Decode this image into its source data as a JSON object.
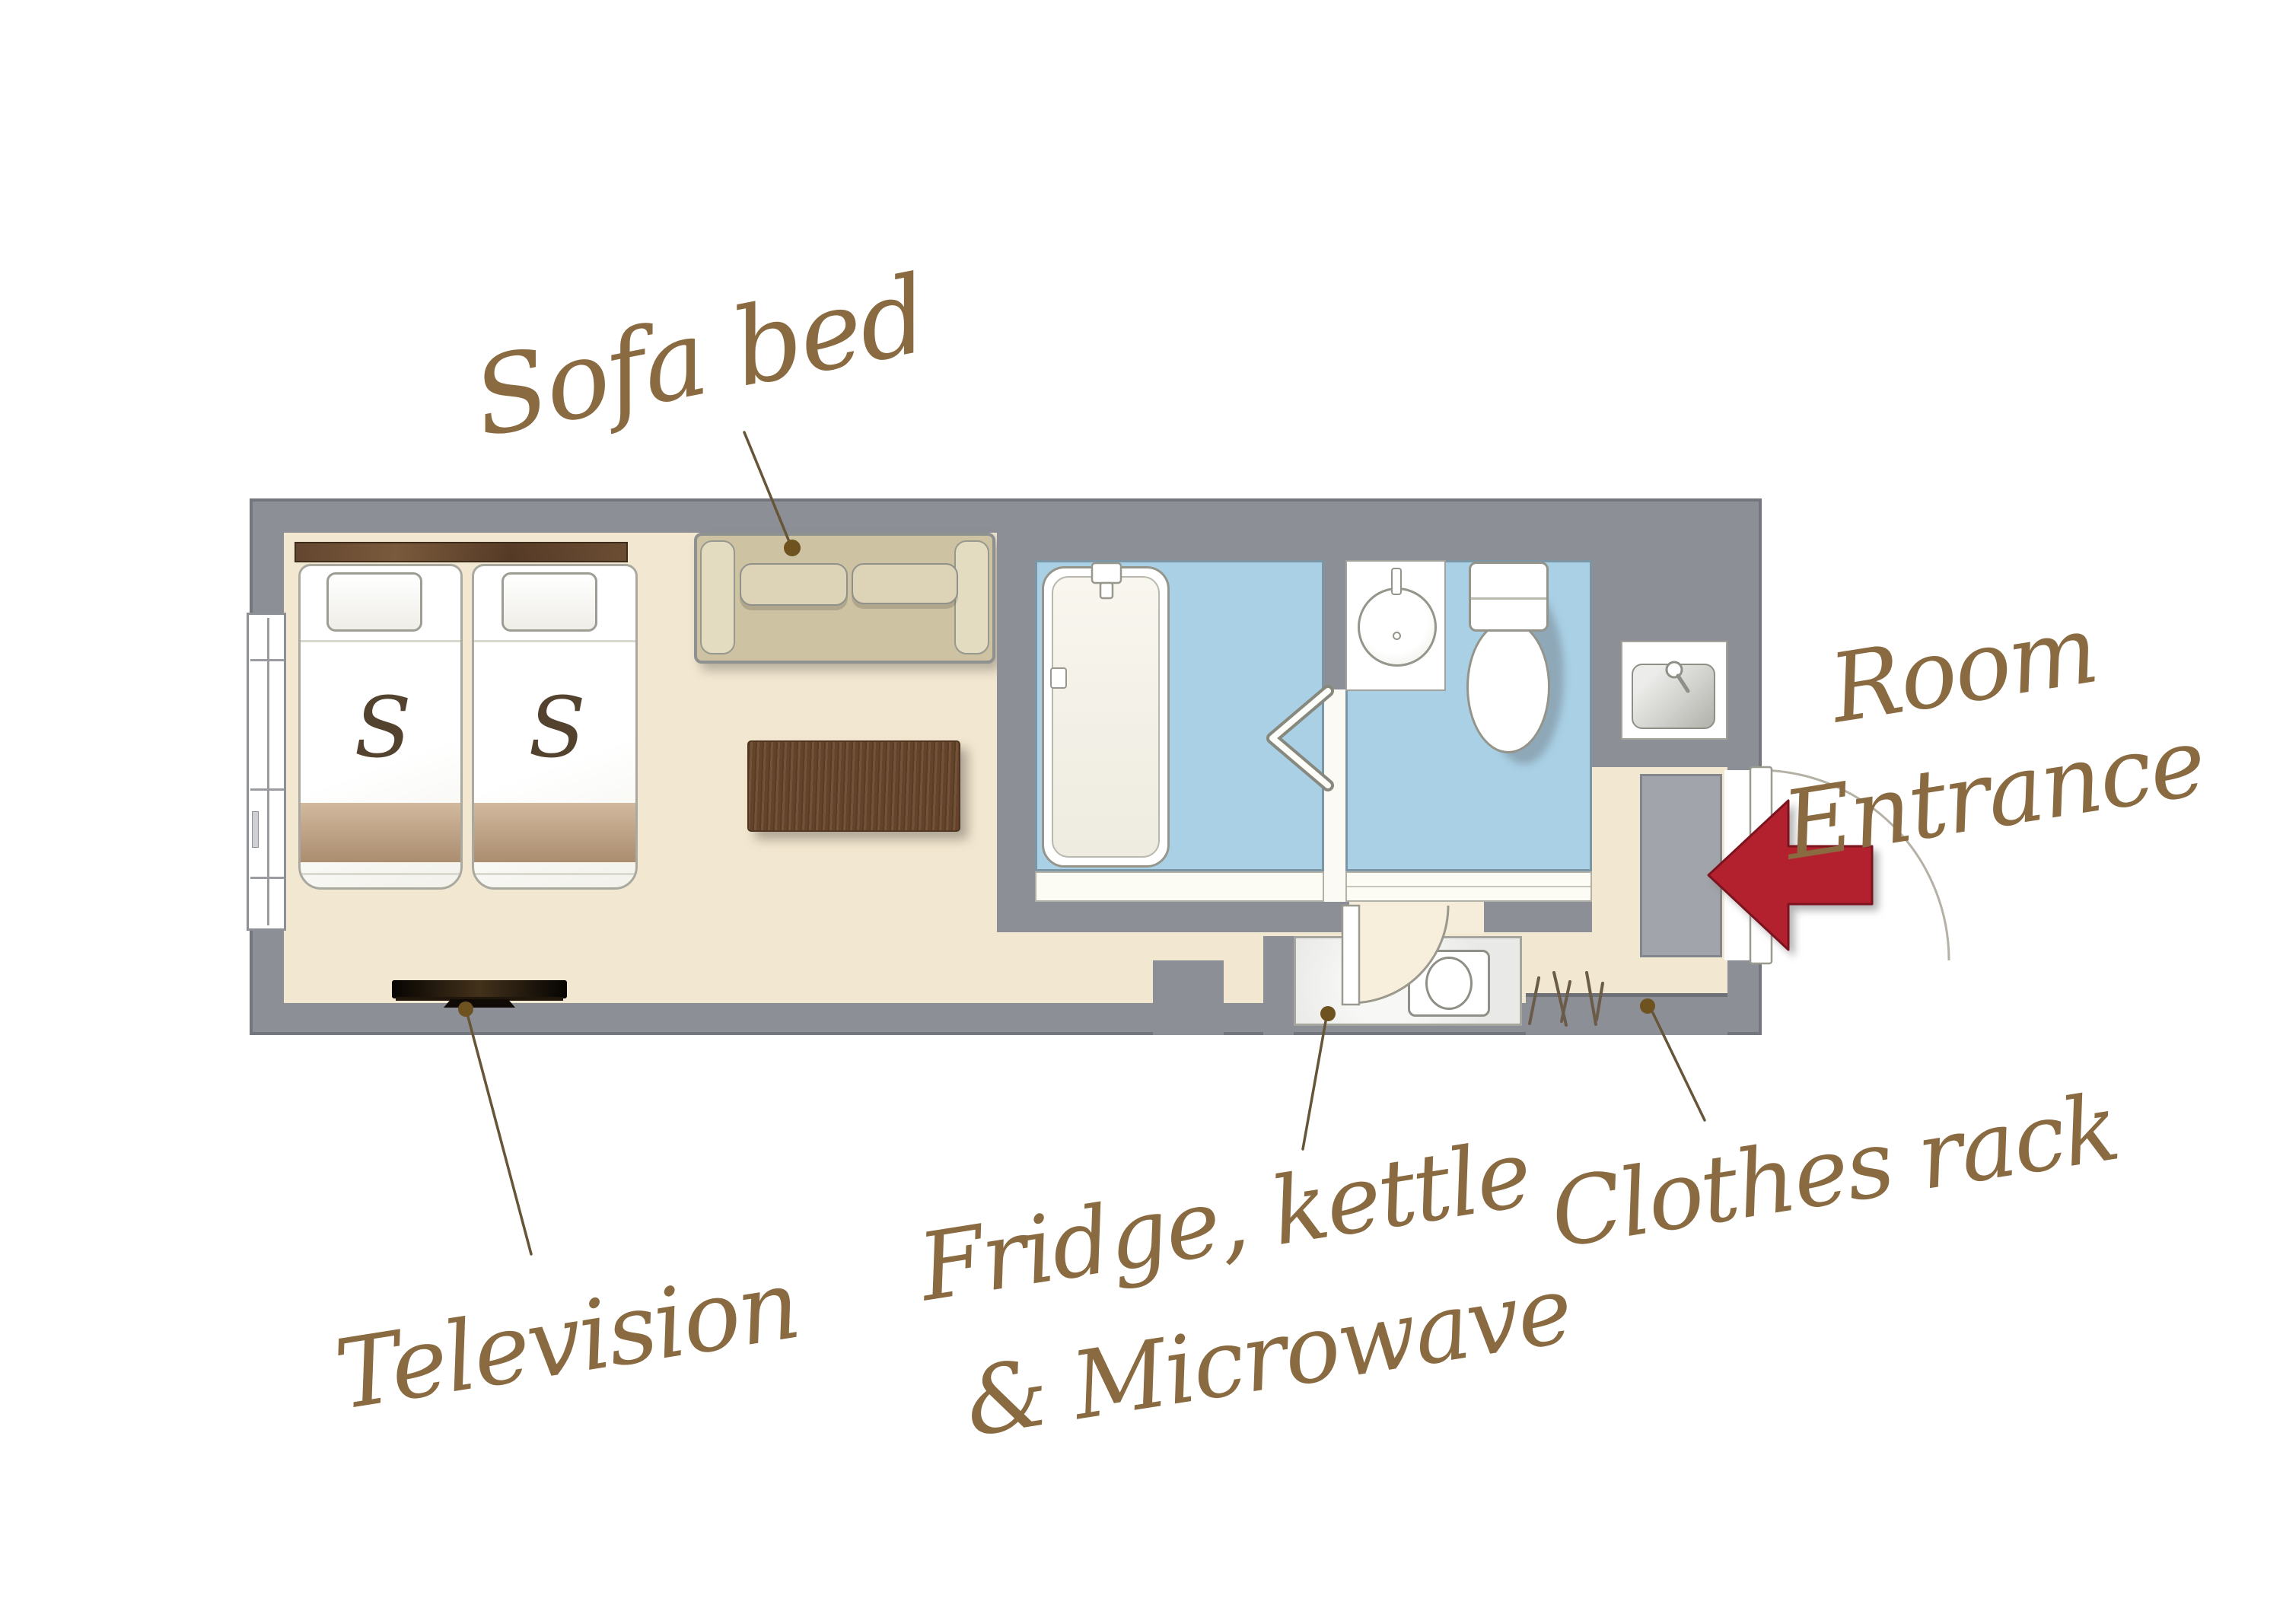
{
  "annotations": {
    "sofa_bed": "Sofa bed",
    "room_entrance": {
      "line1": "Room",
      "line2": "Entrance"
    },
    "television": "Television",
    "fridge": {
      "line1": "Fridge, kettle",
      "line2": "& Microwave"
    },
    "clothes_rack": "Clothes rack"
  },
  "beds": {
    "left_label": "S",
    "right_label": "S"
  },
  "icons": [
    "single-bed-icon",
    "pillow-icon",
    "sofa-bed-icon",
    "coffee-table-icon",
    "television-icon",
    "bathtub-icon",
    "folding-door-icon",
    "washbasin-icon",
    "toilet-icon",
    "vanity-sink-icon",
    "fridge-icon",
    "microwave-icon",
    "clothes-rack-icon",
    "entrance-door-icon",
    "window-icon",
    "entrance-arrow-icon"
  ],
  "colors": {
    "background": "#ffffff",
    "wall_gray": "#8c8f96",
    "floor_beige": "#f2e7d0",
    "wet_room_blue": "#a9d0e5",
    "entrance_mat_gray": "#a2a4ab",
    "label_brown": "#8a6b41",
    "leader_line_brown": "#665537",
    "arrow_red": "#b2212d",
    "headboard_wood": "#634630",
    "table_wood": "#6e4b30",
    "sofa_tan": "#cdc2a2"
  }
}
